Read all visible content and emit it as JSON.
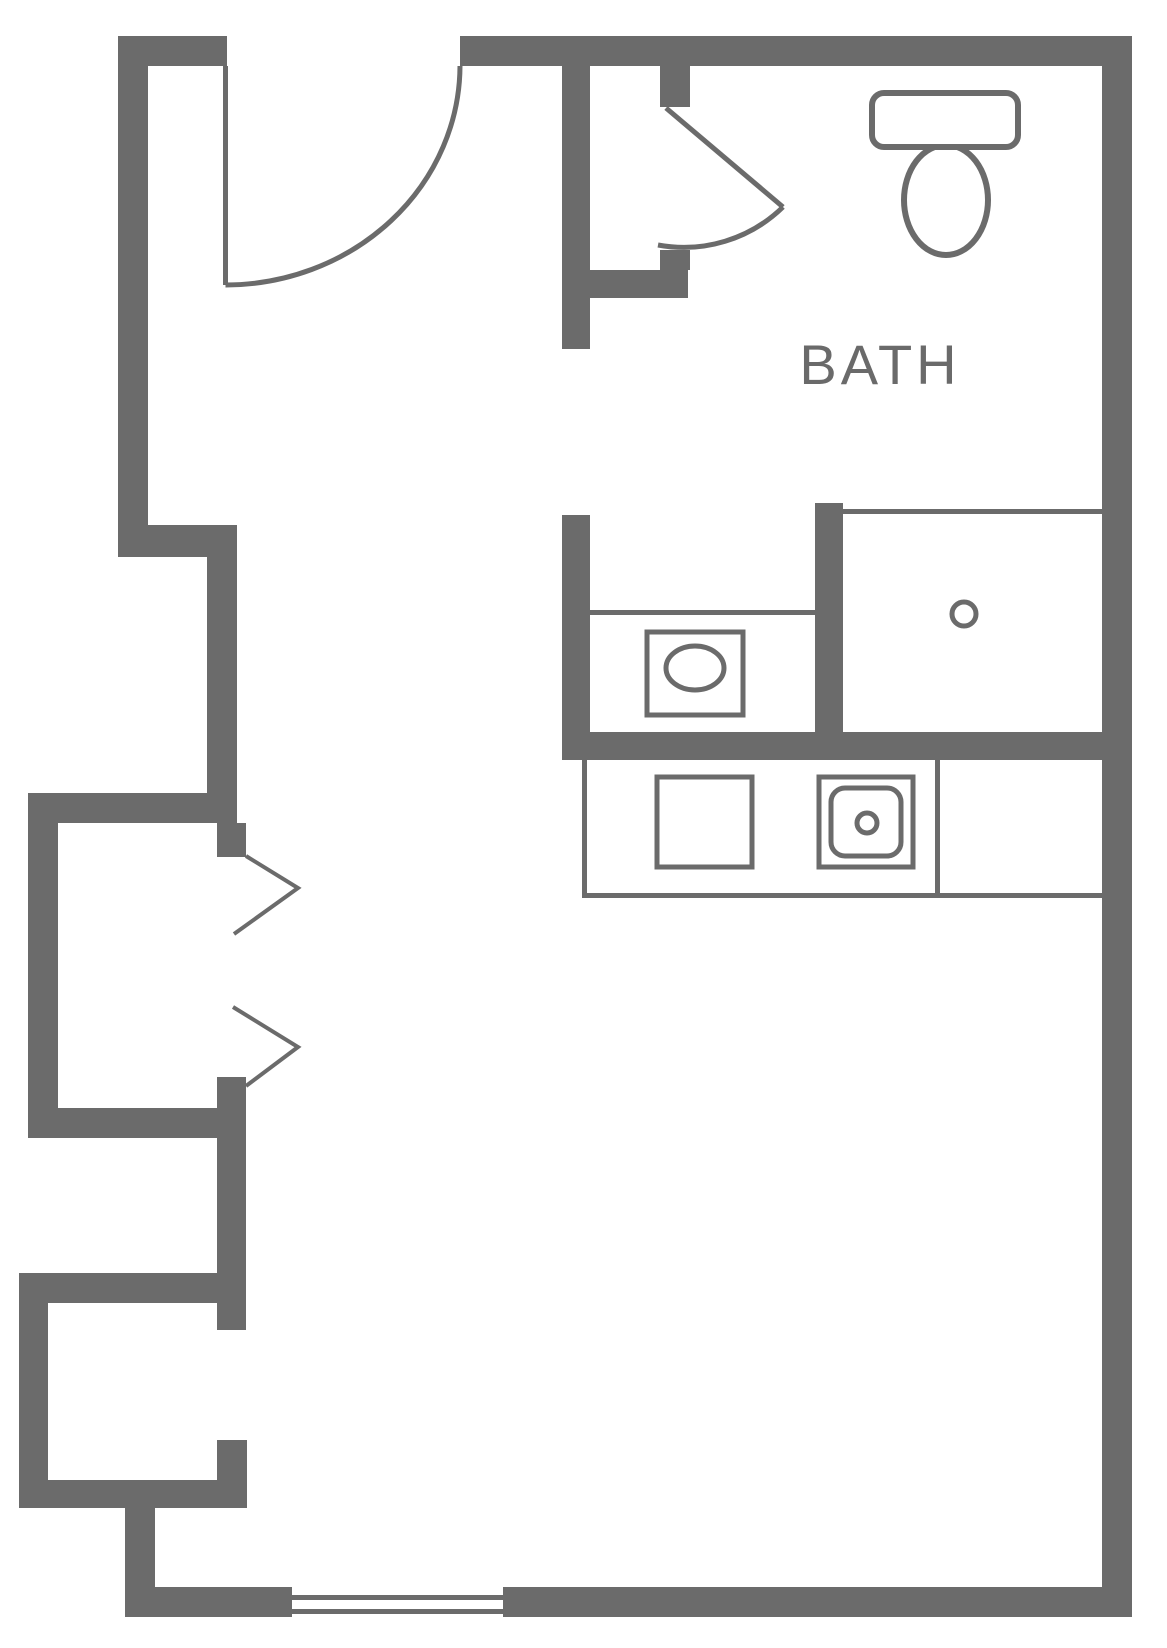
{
  "colors": {
    "wall": "#6b6b6b",
    "text": "#6a6a6a",
    "background": "#ffffff"
  },
  "plan": {
    "rooms": {
      "bath": {
        "label": "BATH"
      }
    },
    "fixtures": [
      "entry-door-swing",
      "bath-door-swing",
      "toilet",
      "shower-stall",
      "shower-drain",
      "vanity-sink",
      "kitchen-counter",
      "cooktop",
      "kitchen-sink",
      "closet-upper",
      "closet-lower",
      "closet-door-chevrons",
      "window"
    ]
  }
}
